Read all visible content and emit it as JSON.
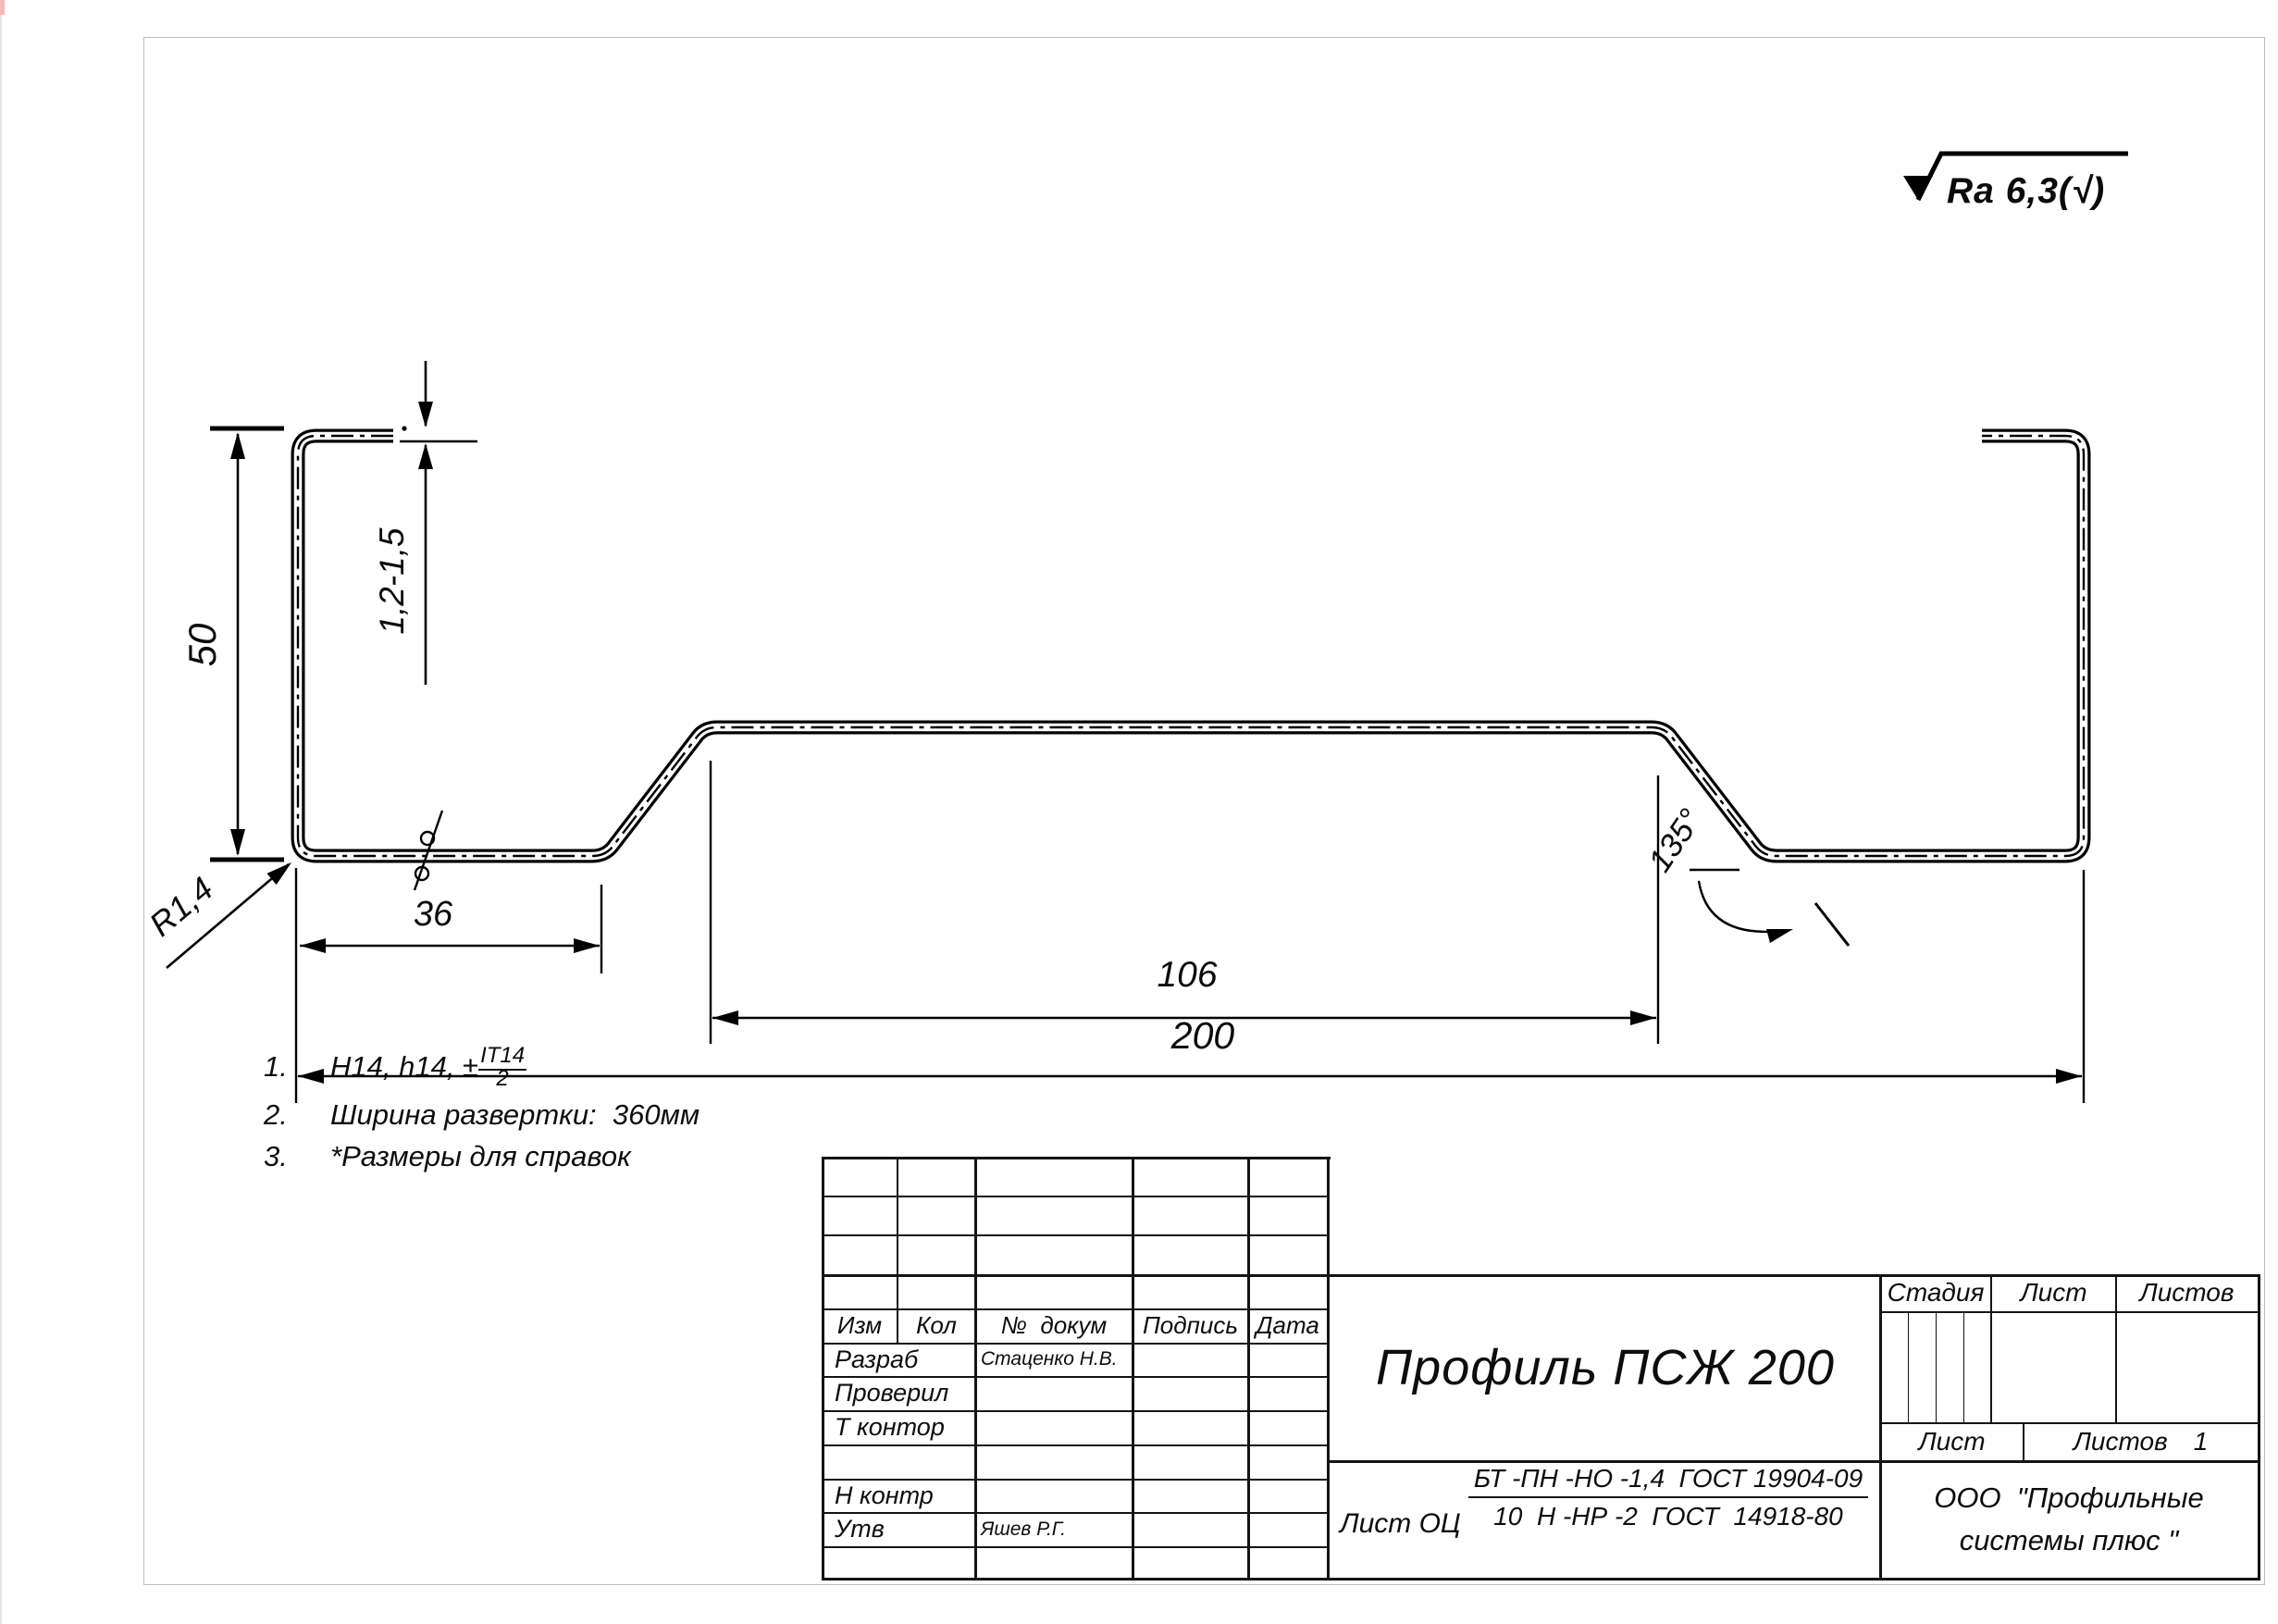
{
  "roughness": {
    "label": "Ra 6,3(√)"
  },
  "dims": {
    "height": "50",
    "thickness": "1,2-1,5",
    "radius": "R1,4",
    "flange": "36",
    "web": "106",
    "overall": "200",
    "angle": "135°"
  },
  "notes": {
    "items": [
      {
        "num": "1.",
        "prefix": "H14, h14, ±",
        "frac_num": "IT14",
        "frac_den": "2"
      },
      {
        "num": "2.",
        "text": "Ширина развертки:  360мм"
      },
      {
        "num": "3.",
        "text": "*Размеры для справок"
      }
    ]
  },
  "title_block": {
    "rev_header": [
      "Изм",
      "Кол",
      "№  докум",
      "Подпись",
      "Дата"
    ],
    "sig_rows": [
      {
        "label": "Разраб",
        "name": "Стаценко Н.В."
      },
      {
        "label": "Проверил",
        "name": ""
      },
      {
        "label": "Т контор",
        "name": ""
      },
      {
        "label": "",
        "name": ""
      },
      {
        "label": "Н контр",
        "name": ""
      },
      {
        "label": "Утв",
        "name": "Яшев Р.Г."
      }
    ],
    "title": "Профиль ПСЖ 200",
    "stage_header": [
      "Стадия",
      "Лист",
      "Листов"
    ],
    "sheet_row": {
      "sheet_label": "Лист",
      "sheets_label": "Листов",
      "sheets_value": "1"
    },
    "material": {
      "prefix": "Лист ОЦ",
      "numerator": "БТ -ПН -НО -1,4  ГОСТ 19904-09",
      "denominator": "10  Н -НР -2  ГОСТ  14918-80"
    },
    "company_line1": "ООО  \"Профильные",
    "company_line2": "системы плюс \""
  }
}
